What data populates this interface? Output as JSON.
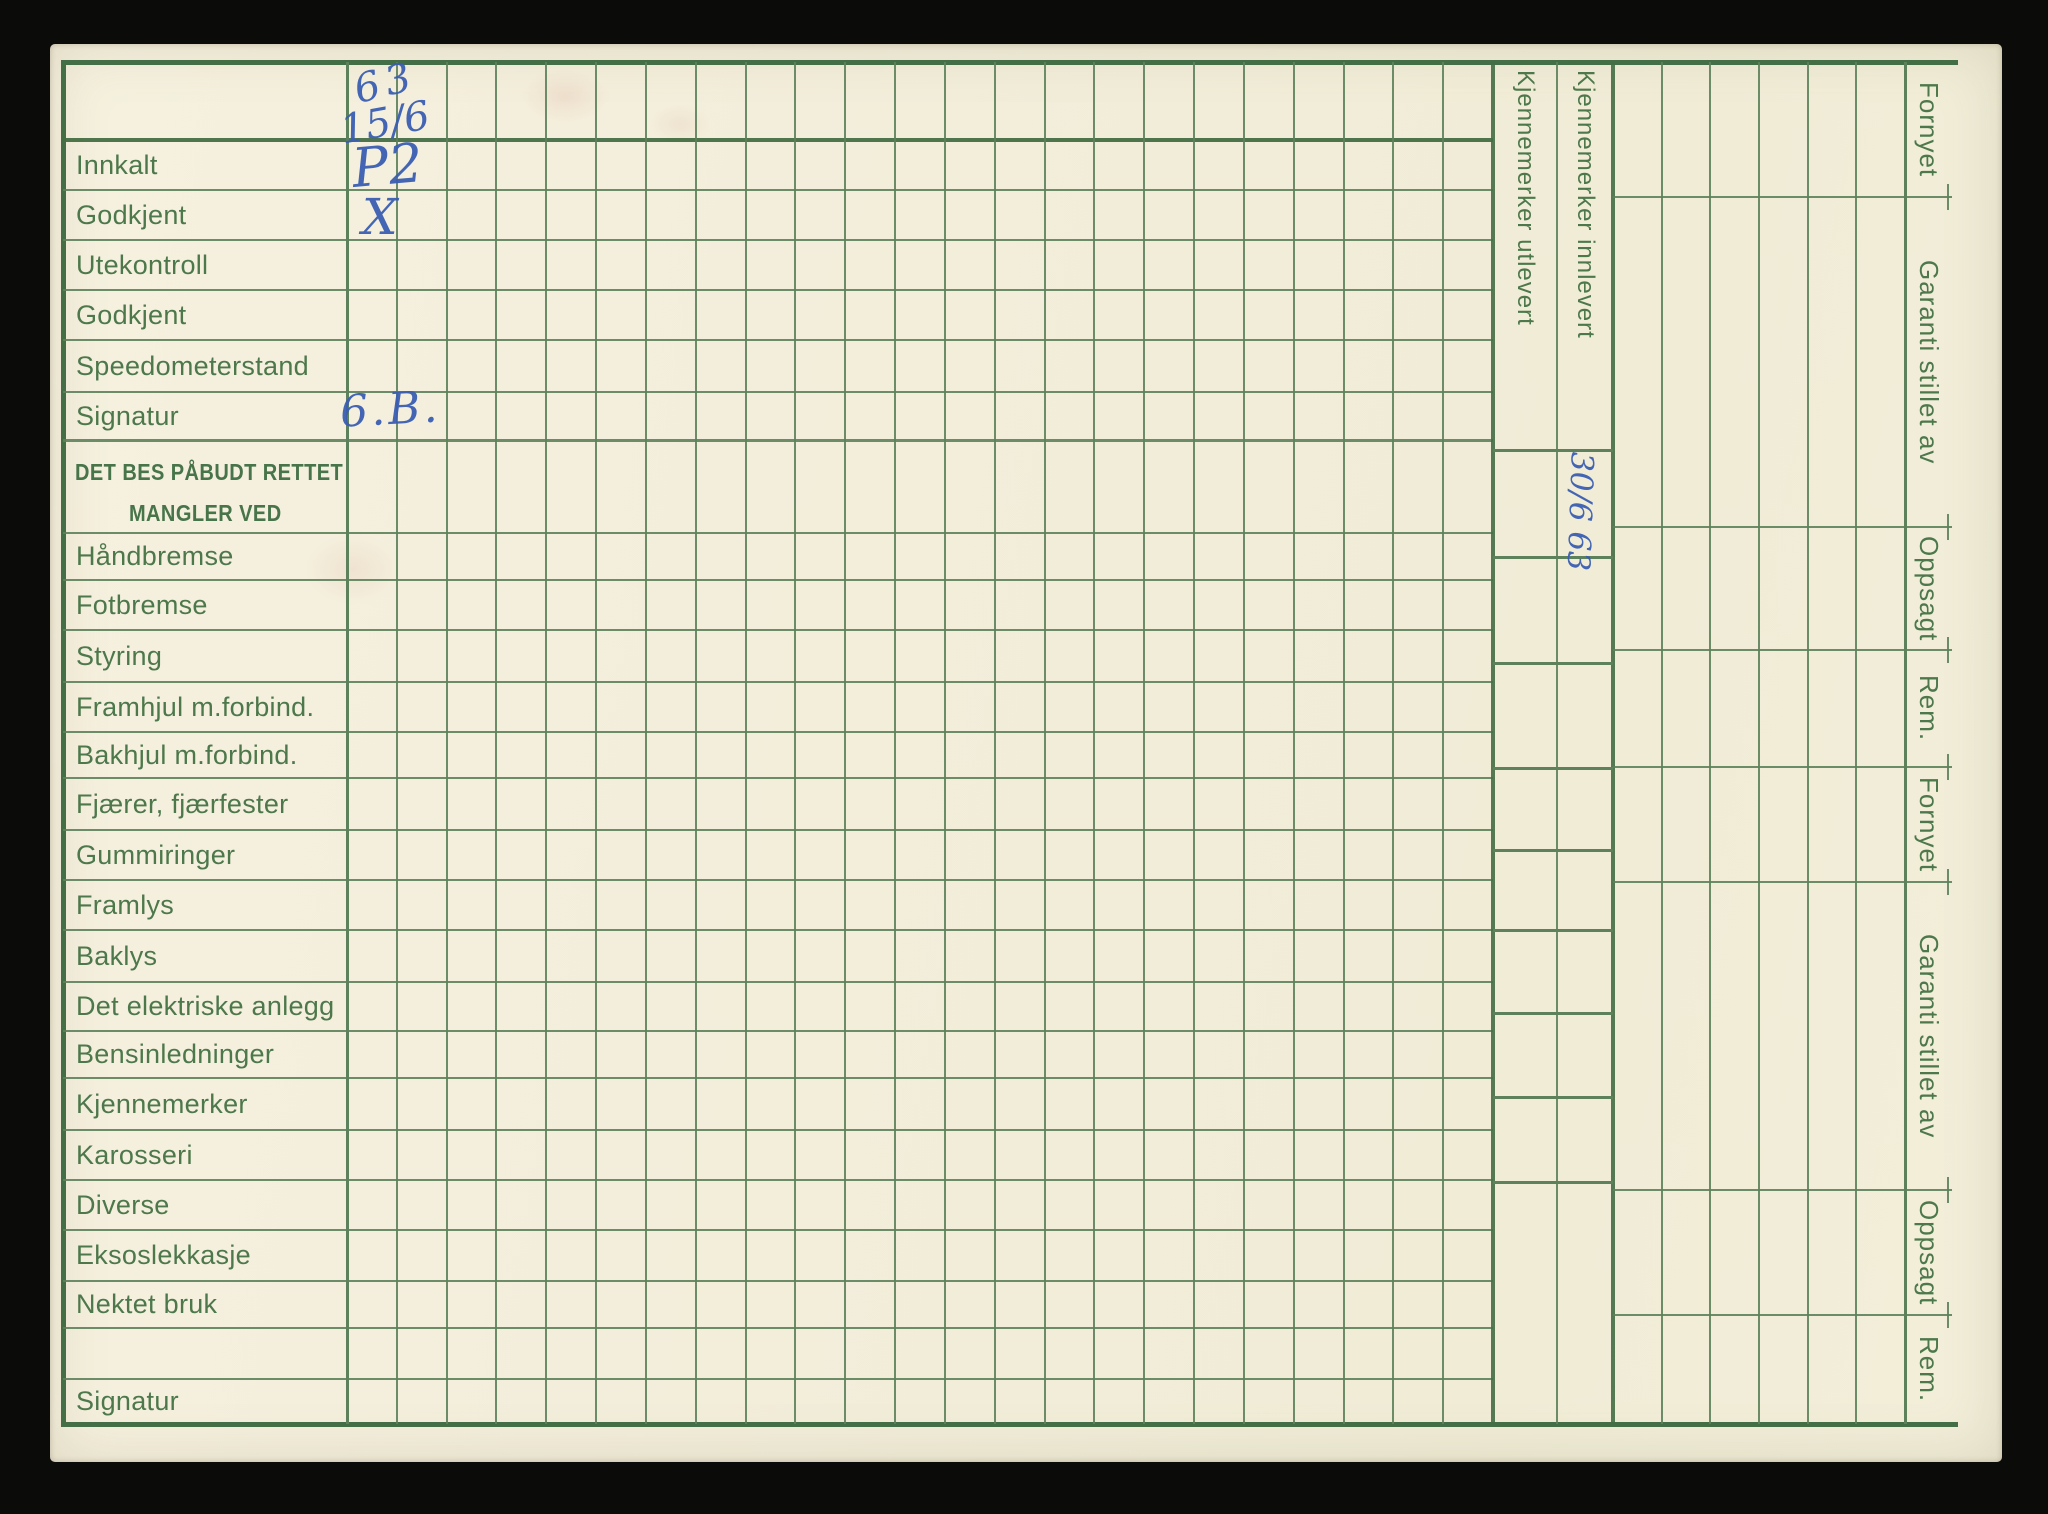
{
  "form": {
    "header_note": {
      "year": "63",
      "date": "15/6"
    },
    "rows": [
      {
        "label": "Innkalt",
        "entry": "P2"
      },
      {
        "label": "Godkjent",
        "entry": "X"
      },
      {
        "label": "Utekontroll",
        "entry": ""
      },
      {
        "label": "Godkjent",
        "entry": ""
      },
      {
        "label": "Speedometerstand",
        "entry": ""
      },
      {
        "label": "Signatur",
        "entry": "6.B."
      },
      {
        "label": "DET BES PÅBUDT RETTET",
        "label2": "MANGLER VED",
        "entry": ""
      },
      {
        "label": "Håndbremse",
        "entry": ""
      },
      {
        "label": "Fotbremse",
        "entry": ""
      },
      {
        "label": "Styring",
        "entry": ""
      },
      {
        "label": "Framhjul m.forbind.",
        "entry": ""
      },
      {
        "label": "Bakhjul m.forbind.",
        "entry": ""
      },
      {
        "label": "Fjærer, fjærfester",
        "entry": ""
      },
      {
        "label": "Gummiringer",
        "entry": ""
      },
      {
        "label": "Framlys",
        "entry": ""
      },
      {
        "label": "Baklys",
        "entry": ""
      },
      {
        "label": "Det elektriske anlegg",
        "entry": ""
      },
      {
        "label": "Bensinledninger",
        "entry": ""
      },
      {
        "label": "Kjennemerker",
        "entry": ""
      },
      {
        "label": "Karosseri",
        "entry": ""
      },
      {
        "label": "Diverse",
        "entry": ""
      },
      {
        "label": "Eksoslekkasje",
        "entry": ""
      },
      {
        "label": "Nektet bruk",
        "entry": ""
      },
      {
        "label": "",
        "entry": ""
      },
      {
        "label": "Signatur",
        "entry": ""
      }
    ],
    "plate_columns": [
      {
        "label": "Kjennemerker utlevert",
        "entry": ""
      },
      {
        "label": "Kjennemerker innlevert",
        "entry": "30/6 63"
      }
    ],
    "right_labels": [
      "Fornyet",
      "Garanti stillet av",
      "Oppsagt",
      "Rem.",
      "Fornyet",
      "Garanti stillet av",
      "Oppsagt",
      "Rem."
    ],
    "colors": {
      "paper": "#f3eedb",
      "grid_green": "#5d815b",
      "grid_green_heavy": "#446e45",
      "label_green": "#4d784b",
      "ink_blue": "#3a5eb2",
      "background": "#0b0b09"
    }
  }
}
